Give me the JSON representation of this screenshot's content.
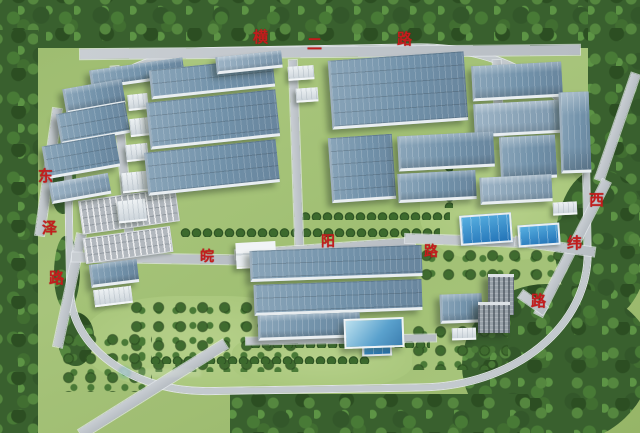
{
  "road_labels": {
    "top_road": {
      "full_name": "横二路",
      "chars": [
        "横",
        "二",
        "路"
      ]
    },
    "left_road": {
      "full_name": "东泽路",
      "chars": [
        "东",
        "泽",
        "路"
      ]
    },
    "middle_road": {
      "full_name": "皖阳路",
      "chars": [
        "皖",
        "阳",
        "路"
      ]
    },
    "right_road": {
      "full_name": "西纬路",
      "chars": [
        "西",
        "纬",
        "路"
      ]
    }
  },
  "palette": {
    "label_red": "#c31d1d",
    "road_gray": "#bfc5ca",
    "roof_blue": "#7b97ae",
    "grass_green": "#a3c077",
    "forest_green": "#3a612f",
    "water_blue": "#2f80c2"
  },
  "watermark": {
    "icon": "faint-developer-logo"
  }
}
